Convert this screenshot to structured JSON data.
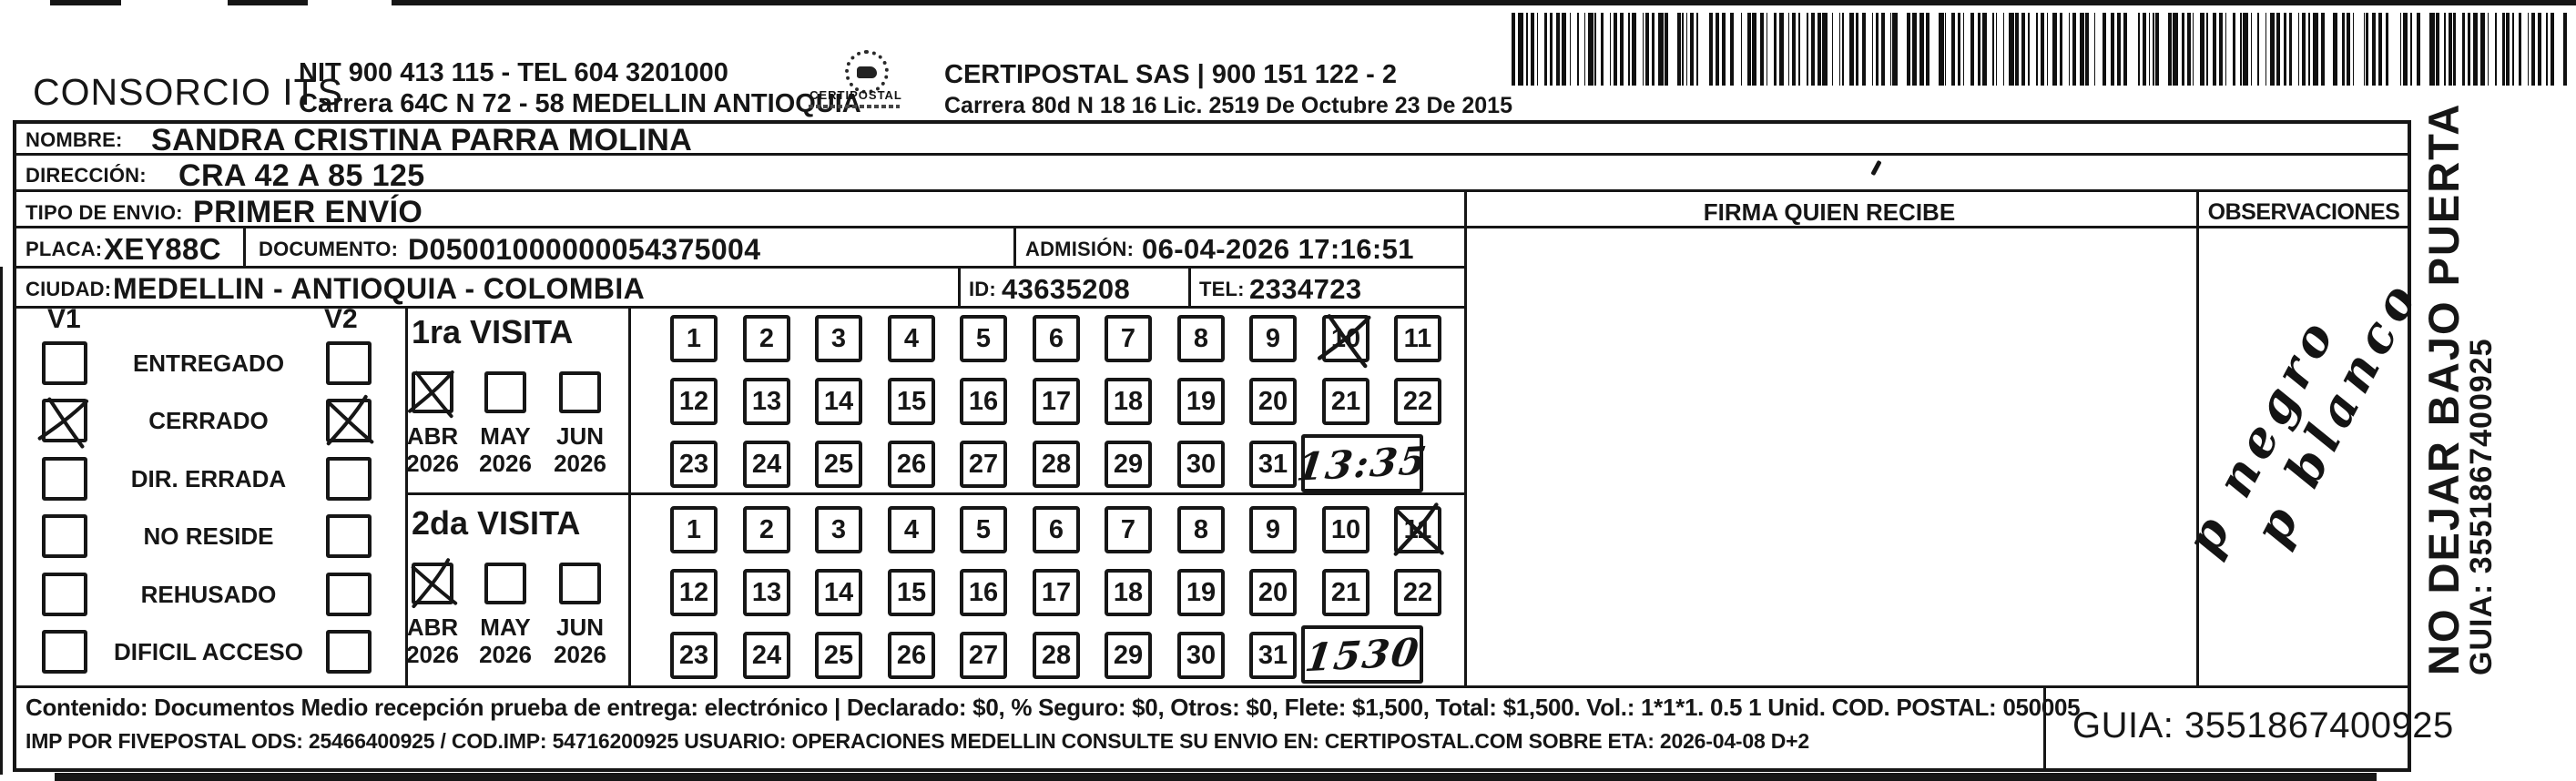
{
  "colors": {
    "ink": "#161616",
    "paper": "#ffffff"
  },
  "header": {
    "consorcio": "CONSORCIO ITS",
    "nit_line": "NIT 900 413 115 - TEL 604 3201000",
    "address_line": "Carrera 64C N 72 - 58 MEDELLIN ANTIOQUIA",
    "logo_caption": "CERTIPOSTAL",
    "certipostal_line": "CERTIPOSTAL SAS | 900 151 122 - 2",
    "certipostal_address": "Carrera 80d N 18 16  Lic. 2519 De Octubre 23 De 2015"
  },
  "recipient": {
    "nombre_label": "NOMBRE:",
    "nombre": "SANDRA CRISTINA PARRA MOLINA",
    "direccion_label": "DIRECCIÓN:",
    "direccion": "CRA 42 A 85 125",
    "tipo_label": "TIPO DE ENVIO:",
    "tipo": "PRIMER ENVÍO",
    "placa_label": "PLACA:",
    "placa": "XEY88C",
    "documento_label": "DOCUMENTO:",
    "documento": "D05001000000054375004",
    "admision_label": "ADMISIÓN:",
    "admision": "06-04-2026 17:16:51",
    "ciudad_label": "CIUDAD:",
    "ciudad": "MEDELLIN - ANTIOQUIA - COLOMBIA",
    "id_label": "ID:",
    "id_value": "43635208",
    "tel_label": "TEL:",
    "tel": "2334723"
  },
  "status": {
    "v1_label": "V1",
    "v2_label": "V2",
    "rows": [
      {
        "label": "ENTREGADO",
        "v1": false,
        "v2": false
      },
      {
        "label": "CERRADO",
        "v1": true,
        "v2": true
      },
      {
        "label": "DIR. ERRADA",
        "v1": false,
        "v2": false
      },
      {
        "label": "NO RESIDE",
        "v1": false,
        "v2": false
      },
      {
        "label": "REHUSADO",
        "v1": false,
        "v2": false
      },
      {
        "label": "DIFICIL ACCESO",
        "v1": false,
        "v2": false
      }
    ]
  },
  "visits": [
    {
      "title": "1ra VISITA",
      "months": [
        {
          "label": "ABR",
          "year": "2026",
          "checked": true
        },
        {
          "label": "MAY",
          "year": "2026",
          "checked": false
        },
        {
          "label": "JUN",
          "year": "2026",
          "checked": false
        }
      ],
      "days": 31,
      "crossed_day": 10,
      "time_note": "13:35"
    },
    {
      "title": "2da VISITA",
      "months": [
        {
          "label": "ABR",
          "year": "2026",
          "checked": true
        },
        {
          "label": "MAY",
          "year": "2026",
          "checked": false
        },
        {
          "label": "JUN",
          "year": "2026",
          "checked": false
        }
      ],
      "days": 31,
      "crossed_day": 11,
      "time_note": "1530"
    }
  ],
  "firma": {
    "header": "FIRMA QUIEN RECIBE"
  },
  "observaciones": {
    "header": "OBSERVACIONES",
    "handwriting": [
      "p negro",
      "p blanco"
    ]
  },
  "side": {
    "no_dejar": "NO DEJAR BAJO PUERTA",
    "guia_vertical": "GUIA: 3551867400925"
  },
  "footer": {
    "contenido": "Contenido: Documentos Medio recepción prueba de entrega: electrónico | Declarado: $0, % Seguro: $0, Otros: $0, Flete: $1,500, Total: $1,500. Vol.: 1*1*1. 0.5  1 Unid. COD. POSTAL: 050005",
    "imp": "IMP POR FIVEPOSTAL ODS: 25466400925 / COD.IMP: 54716200925 USUARIO: OPERACIONES MEDELLIN CONSULTE SU ENVIO EN: CERTIPOSTAL.COM SOBRE ETA: 2026-04-08 D+2",
    "guia": "GUIA: 3551867400925"
  }
}
